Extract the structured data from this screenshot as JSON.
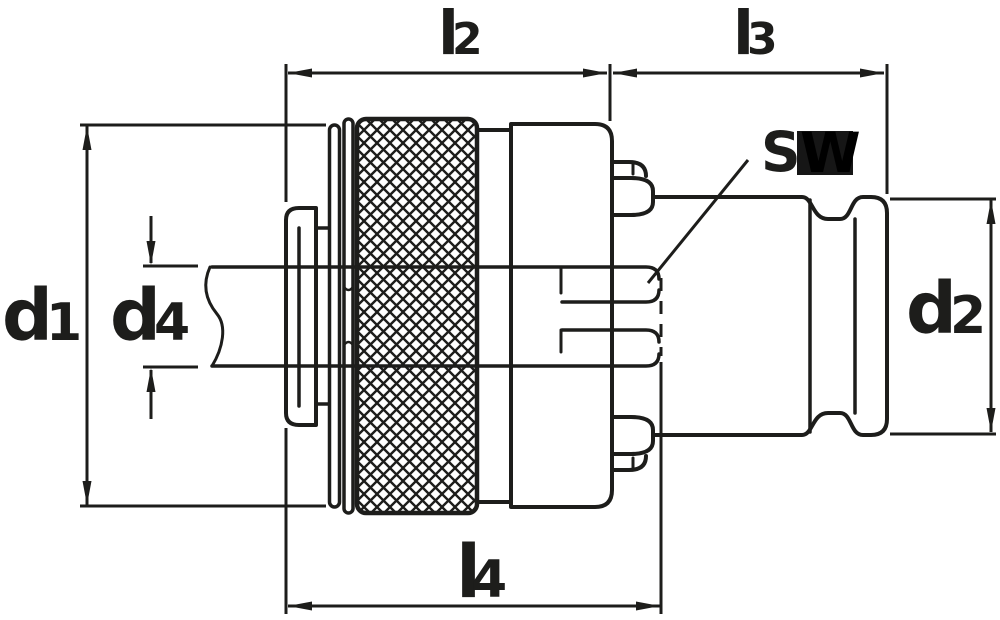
{
  "labels": {
    "d1": {
      "main": "d",
      "sub": "1"
    },
    "d4": {
      "main": "d",
      "sub": "4"
    },
    "d2": {
      "main": "d",
      "sub": "2"
    },
    "l2": {
      "main": "l",
      "sub": "2"
    },
    "l3": {
      "main": "l",
      "sub": "3"
    },
    "l4": {
      "main": "l",
      "sub": "4"
    },
    "sw": {
      "s": "S",
      "w": "W"
    }
  },
  "colors": {
    "line": "#1d1d1b",
    "background": "#ffffff",
    "sw_box": "#161616",
    "sw_w": "#000000"
  }
}
